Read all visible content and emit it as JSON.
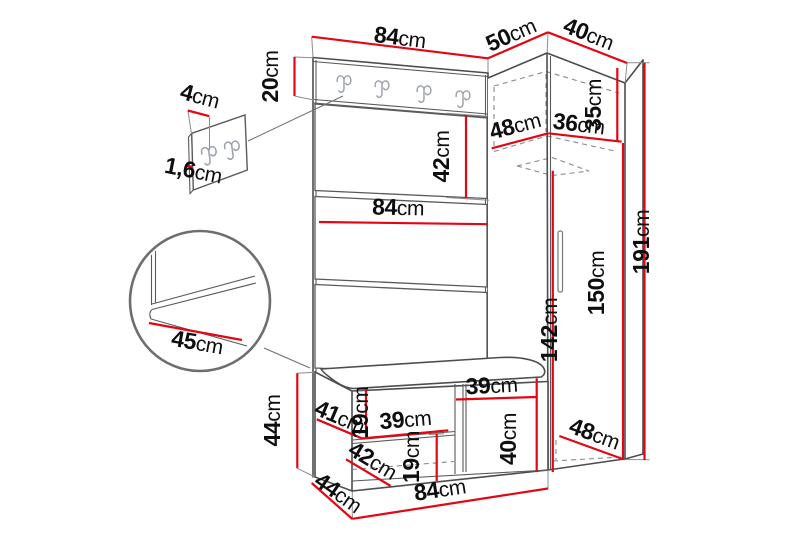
{
  "unit": "cm",
  "colors": {
    "dimension_red": "#e30613",
    "outline_gray": "#4d4d4d",
    "hidden_line_gray": "#8a8a8a",
    "hook_gray": "#9aa1a8",
    "text_black": "#0e0e0e",
    "background": "#ffffff"
  },
  "dims": {
    "panel_width_top": "84",
    "wardrobe_depth_top": "50",
    "wardrobe_width_top": "40",
    "rail_height": "20",
    "plate_width": "4",
    "plate_thickness": "1,6",
    "panel_cushion_height": "42",
    "panel_width_mid": "84",
    "shelf_depth": "48",
    "shelf_width": "36",
    "top_compartment_height": "35",
    "total_height": "191",
    "door_height": "150",
    "interior_height": "142",
    "seat_depth": "45",
    "bench_height": "44",
    "bench_shelf_depth": "41",
    "bench_opening_height": "19",
    "bench_shelf_width": "39",
    "bench_door_width": "39",
    "bench_lower_height": "19",
    "bench_door_height": "40",
    "bench_inner_depth": "42",
    "bench_depth": "44",
    "bench_width": "84",
    "wardrobe_floor_depth": "48"
  }
}
